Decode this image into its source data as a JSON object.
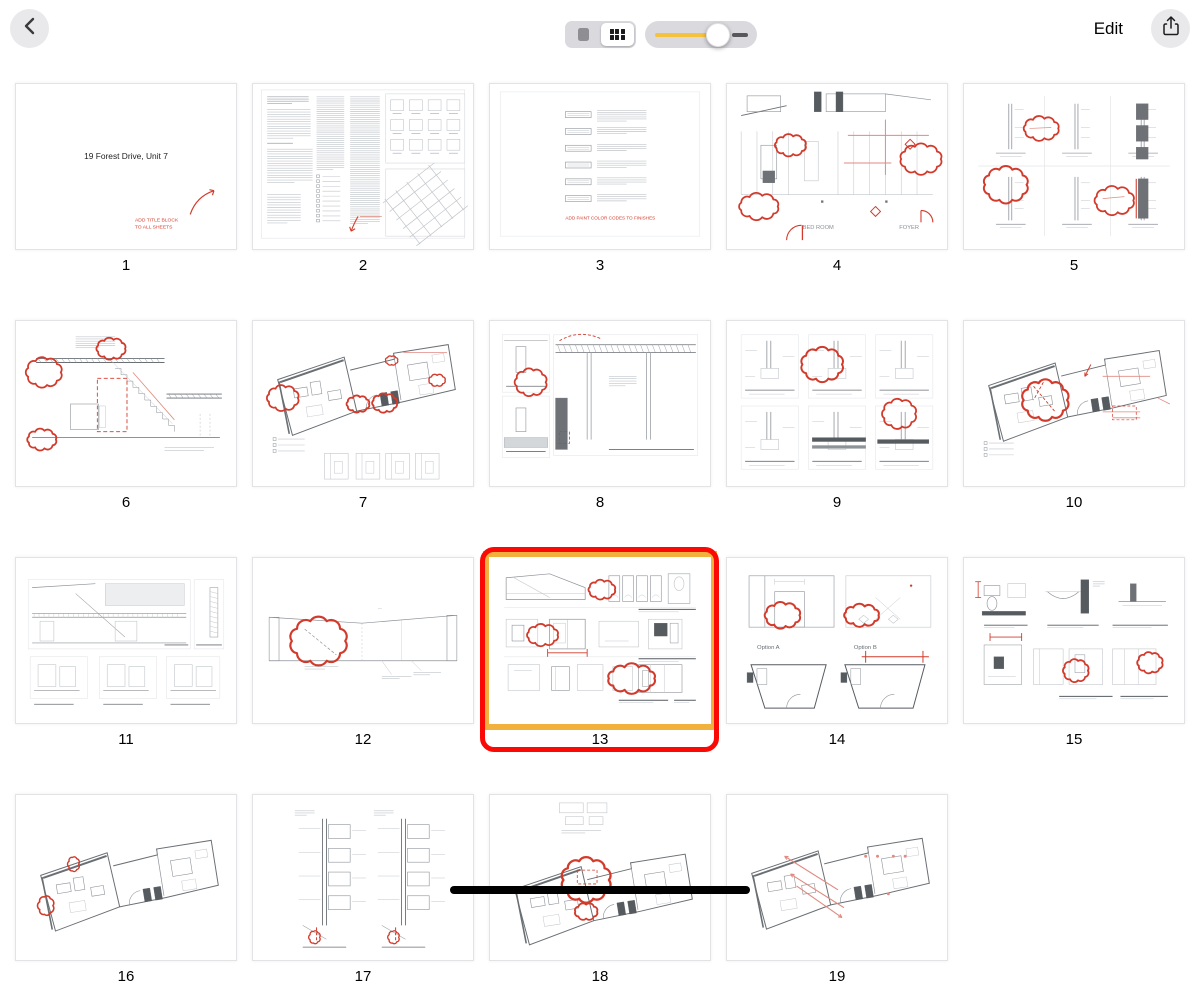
{
  "toolbar": {
    "edit_label": "Edit",
    "icons": {
      "back": "chevron-left",
      "share": "share-up-arrow",
      "view_single": "single-page",
      "view_grid": "grid-view"
    },
    "view_toggle": {
      "options": [
        "single-page",
        "grid"
      ],
      "selected": "grid"
    },
    "zoom_slider": {
      "value_pct": 68
    }
  },
  "colors": {
    "selection_red": "#fb0a05",
    "selection_yellow": "#f2b13c",
    "slider_yellow": "#f6c13b",
    "markup_red": "#d23b2c",
    "markup_red_light": "#e08a80",
    "line_light": "#c2c6cb",
    "line_mid": "#8d9298",
    "line_dark": "#565b60",
    "control_gray": "#d9d9de",
    "toolbar_circle": "#e9e9eb"
  },
  "document": {
    "page_count_visible": 19,
    "selected_page": "13"
  },
  "pages": [
    {
      "num": "1",
      "sketch": "title",
      "selected": false,
      "texts": {
        "title": "19 Forest Drive, Unit 7",
        "note_line1": "ADD TITLE BLOCK",
        "note_line2": "TO ALL SHEETS"
      }
    },
    {
      "num": "2",
      "sketch": "specs",
      "selected": false,
      "texts": {}
    },
    {
      "num": "3",
      "sketch": "schedule",
      "selected": false,
      "texts": {
        "note": "ADD PAINT COLOR CODES TO FINISHES"
      }
    },
    {
      "num": "4",
      "sketch": "planElev",
      "selected": false,
      "texts": {
        "room1": "BED ROOM",
        "room2": "FOYER"
      }
    },
    {
      "num": "5",
      "sketch": "wallSections",
      "selected": false,
      "texts": {}
    },
    {
      "num": "6",
      "sketch": "stairSection",
      "selected": false,
      "texts": {}
    },
    {
      "num": "7",
      "sketch": "skewPlanElec",
      "selected": false,
      "texts": {}
    },
    {
      "num": "8",
      "sketch": "detailSheet",
      "selected": false,
      "texts": {}
    },
    {
      "num": "9",
      "sketch": "detailGrid",
      "selected": false,
      "texts": {}
    },
    {
      "num": "10",
      "sketch": "skewPlanNotes",
      "selected": false,
      "texts": {}
    },
    {
      "num": "11",
      "sketch": "elevSheet",
      "selected": false,
      "texts": {}
    },
    {
      "num": "12",
      "sketch": "longSection",
      "selected": false,
      "texts": {}
    },
    {
      "num": "13",
      "sketch": "interiorElev",
      "selected": true,
      "texts": {}
    },
    {
      "num": "14",
      "sketch": "options",
      "selected": false,
      "texts": {
        "optionA": "Option A",
        "optionB": "Option B"
      }
    },
    {
      "num": "15",
      "sketch": "bathElev",
      "selected": false,
      "texts": {}
    },
    {
      "num": "16",
      "sketch": "skewPlanSmall",
      "selected": false,
      "texts": {}
    },
    {
      "num": "17",
      "sketch": "cabinetDetails",
      "selected": false,
      "texts": {}
    },
    {
      "num": "18",
      "sketch": "skewPlanCloud",
      "selected": false,
      "texts": {}
    },
    {
      "num": "19",
      "sketch": "skewPlanArrows",
      "selected": false,
      "texts": {}
    }
  ]
}
